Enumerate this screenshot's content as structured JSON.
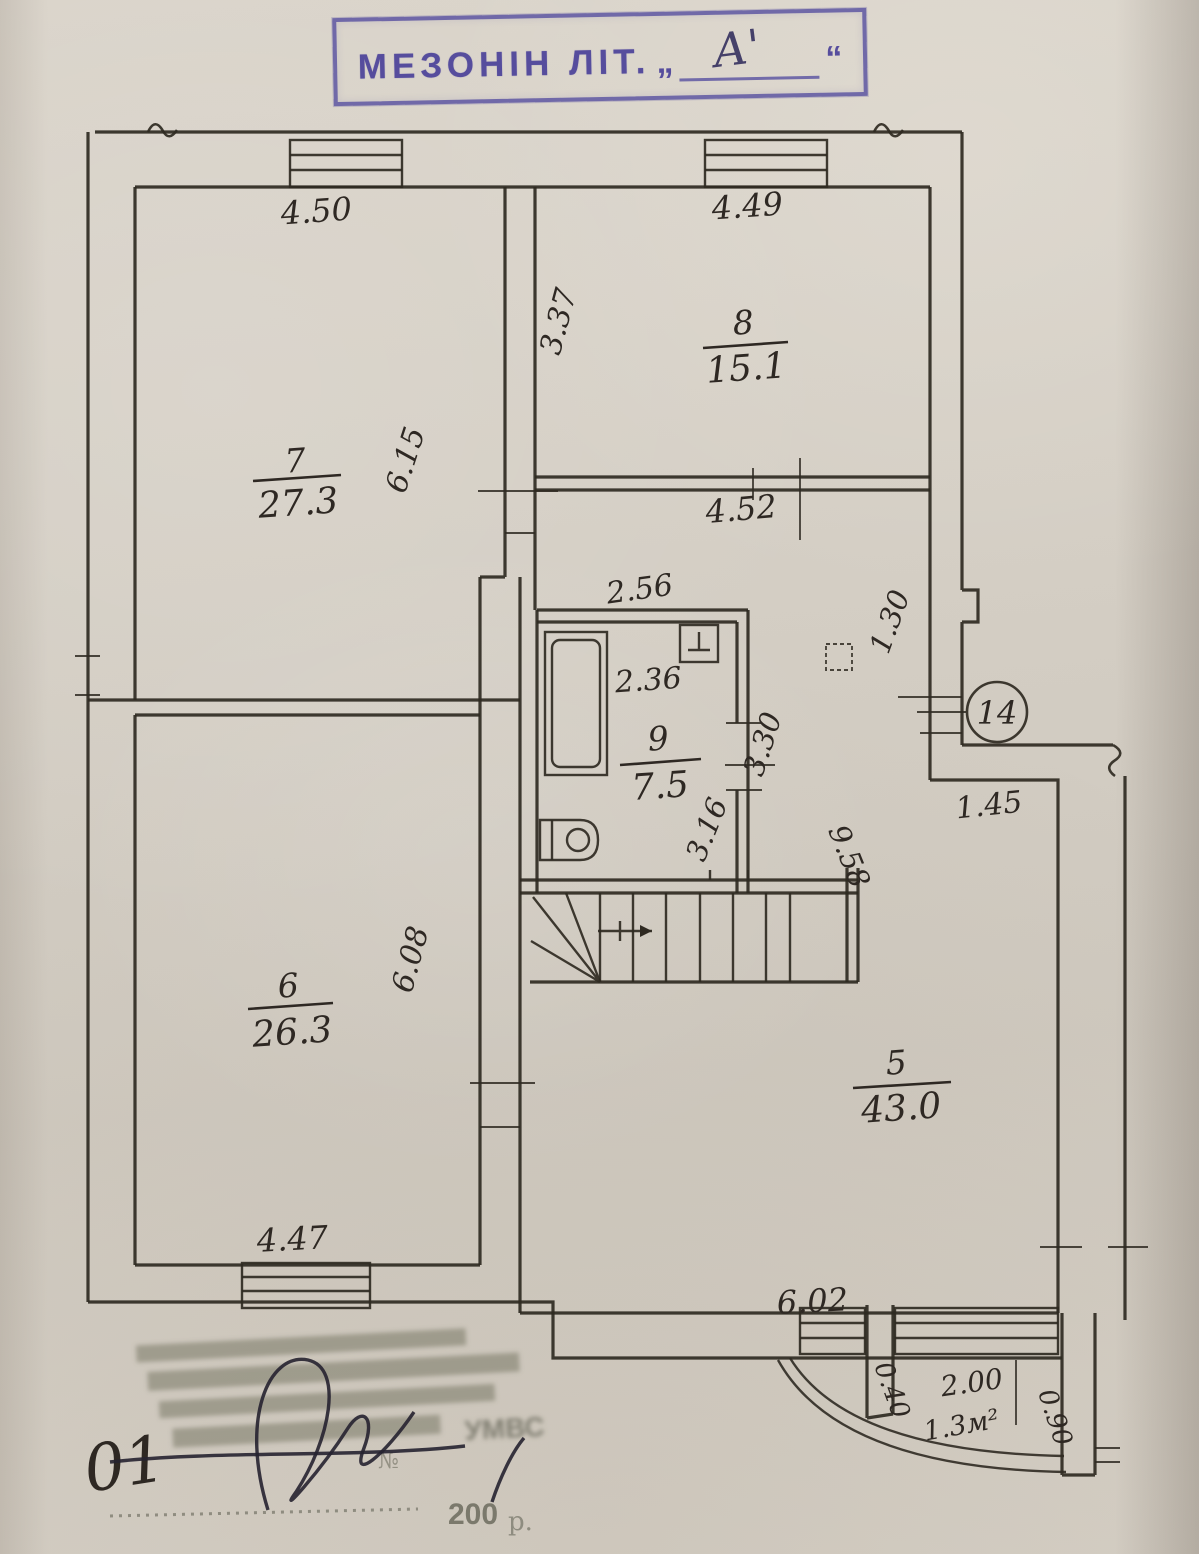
{
  "top_stamp": {
    "label": "МЕЗОНІН ЛІТ.",
    "open_quote": "„",
    "letter": "А'",
    "close_quote": "“"
  },
  "plan": {
    "rooms": [
      {
        "number": "7",
        "area": "27.3"
      },
      {
        "number": "8",
        "area": "15.1"
      },
      {
        "number": "9",
        "area": "7.5"
      },
      {
        "number": "6",
        "area": "26.3"
      },
      {
        "number": "5",
        "area": "43.0"
      }
    ],
    "dims": [
      {
        "t": "4.50"
      },
      {
        "t": "4.49"
      },
      {
        "t": "3.37"
      },
      {
        "t": "6.15"
      },
      {
        "t": "4.52"
      },
      {
        "t": "2.56"
      },
      {
        "t": "2.36"
      },
      {
        "t": "3.30"
      },
      {
        "t": "1.30"
      },
      {
        "t": "3.16"
      },
      {
        "t": "9.58"
      },
      {
        "t": "1.45"
      },
      {
        "t": "6.08"
      },
      {
        "t": "4.47"
      },
      {
        "t": "6.02"
      },
      {
        "t": "0.40"
      },
      {
        "t": "2.00"
      },
      {
        "t": "1.3м²"
      },
      {
        "t": "0.90"
      }
    ],
    "markers": {
      "point": "14"
    }
  },
  "bottom_stamp": {
    "handwritten_number": "01",
    "org_fragment": "УМВС",
    "number_sign": "№",
    "year_prefix": "200",
    "year_suffix": "р."
  },
  "colors": {
    "ink": "#2f2a22",
    "stamp_violet": "#574e9e",
    "faded_gray": "#6c6c5c"
  }
}
